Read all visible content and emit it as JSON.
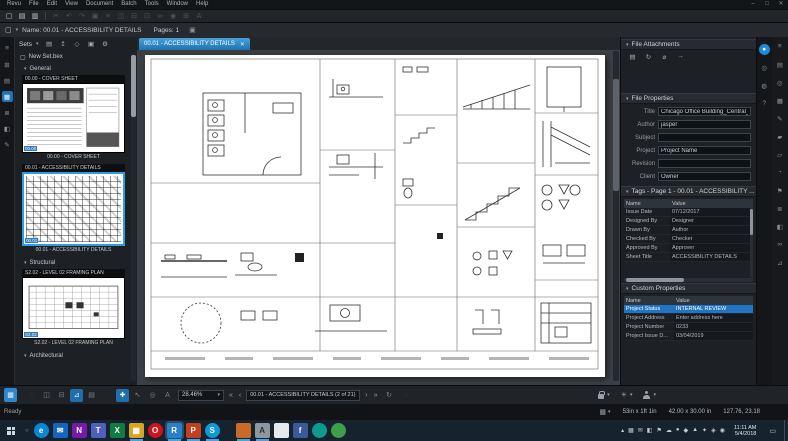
{
  "app": {
    "menus": [
      "Revu",
      "File",
      "Edit",
      "View",
      "Document",
      "Batch",
      "Tools",
      "Window",
      "Help"
    ],
    "window_controls": [
      {
        "name": "minimize-button",
        "glyph": "–"
      },
      {
        "name": "maximize-button",
        "glyph": "□"
      },
      {
        "name": "close-button",
        "glyph": "✕"
      }
    ]
  },
  "toolbar": {
    "icons": [
      {
        "name": "new-document-icon",
        "glyph": "▢"
      },
      {
        "name": "open-file-icon",
        "glyph": "▤"
      },
      {
        "name": "save-file-icon",
        "glyph": "▥"
      },
      {
        "name": "toolbar-separator",
        "glyph": "",
        "cls": "sep"
      },
      {
        "name": "cut-icon",
        "glyph": "✂",
        "cls": "dim"
      },
      {
        "name": "undo-icon",
        "glyph": "↶",
        "cls": "dim"
      },
      {
        "name": "redo-icon",
        "glyph": "↷",
        "cls": "dim"
      },
      {
        "name": "paste-icon",
        "glyph": "▣",
        "cls": "dim"
      },
      {
        "name": "flatten-icon",
        "glyph": "≡",
        "cls": "dim"
      },
      {
        "name": "compare-icon",
        "glyph": "◫",
        "cls": "dim"
      },
      {
        "name": "overlay-icon",
        "glyph": "⊟",
        "cls": "dim"
      },
      {
        "name": "snapshot-icon",
        "glyph": "⊡",
        "cls": "dim"
      },
      {
        "name": "link-icon",
        "glyph": "∞",
        "cls": "dim"
      },
      {
        "name": "stamp-icon",
        "glyph": "◉",
        "cls": "dim"
      },
      {
        "name": "form-icon",
        "glyph": "⊞",
        "cls": "dim"
      },
      {
        "name": "ocr-icon",
        "glyph": "A",
        "cls": "dim"
      }
    ]
  },
  "infobar": {
    "doc_icon": "▢",
    "caret": "▾",
    "name_label": "Name: 00.01 - ACCESSIBILITY DETAILS",
    "pages_label": "Pages: 1",
    "copy_icon": "▣"
  },
  "left_rail": {
    "icons": [
      {
        "name": "file-access-panel-icon",
        "glyph": "≡"
      },
      {
        "name": "thumbnails-panel-icon",
        "glyph": "⊞"
      },
      {
        "name": "bookmarks-panel-icon",
        "glyph": "▤"
      },
      {
        "name": "sets-panel-icon",
        "glyph": "▦",
        "cls": "active"
      },
      {
        "name": "layers-panel-icon",
        "glyph": "≣"
      },
      {
        "name": "spaces-panel-icon",
        "glyph": "◧"
      },
      {
        "name": "signatures-panel-icon",
        "glyph": "✎"
      }
    ]
  },
  "sidebar": {
    "sets_label": "Sets",
    "sets_caret": "▾",
    "tools": [
      {
        "name": "open-set-icon",
        "glyph": "▤"
      },
      {
        "name": "add-to-set-icon",
        "glyph": "↥"
      },
      {
        "name": "tag-set-icon",
        "glyph": "◇"
      },
      {
        "name": "lock-set-icon",
        "glyph": "▣"
      },
      {
        "name": "set-settings-icon",
        "glyph": "⚙"
      }
    ],
    "new_set_icon": "▢",
    "new_set_label": "New Set.bex",
    "sections": [
      {
        "caret": "▾",
        "label": "General"
      },
      {
        "caret": "▾",
        "label": "Structural"
      },
      {
        "caret": "▾",
        "label": "Architectural"
      }
    ],
    "items": [
      {
        "title": "00.00 - COVER SHEET",
        "caption": "00.00 - COVER SHEET",
        "chip": "00.00"
      },
      {
        "title": "00.01 - ACCESSIBILITY DETAILS",
        "caption": "00.01 - ACCESSIBILITY DETAILS",
        "chip": "00.01"
      },
      {
        "title": "S2.02 - LEVEL 02 FRAMING PLAN",
        "caption": "S2.02 - LEVEL 02 FRAMING PLAN",
        "chip": "S2.02"
      }
    ]
  },
  "document": {
    "tab_label": "00.01 - ACCESSIBILITY DETAILS",
    "tab_close": "✕"
  },
  "right_panel": {
    "attachments": {
      "caret": "▾",
      "label": "File Attachments",
      "icons": [
        {
          "name": "attachment-folder-icon",
          "glyph": "▤"
        },
        {
          "name": "attachment-refresh-icon",
          "glyph": "↻"
        },
        {
          "name": "paperclip-icon",
          "glyph": "⌀"
        },
        {
          "name": "attachment-open-icon",
          "glyph": "→"
        }
      ]
    },
    "properties": {
      "caret": "▾",
      "label": "File Properties",
      "fields": [
        {
          "label": "Title",
          "value": "Chicago Office Building_Central_par"
        },
        {
          "label": "Author",
          "value": "jasper"
        },
        {
          "label": "Subject",
          "value": ""
        },
        {
          "label": "Project",
          "value": "Project Name"
        },
        {
          "label": "Revision",
          "value": ""
        },
        {
          "label": "Client",
          "value": "Owner"
        }
      ]
    },
    "tags": {
      "caret": "▾",
      "label": "Tags - Page 1 - 00.01 - ACCESSIBILITY ...",
      "col_name": "Name",
      "col_value": "Value",
      "rows": [
        [
          "Issue Date",
          "07/12/2017"
        ],
        [
          "Designed By",
          "Designer"
        ],
        [
          "Drawn By",
          "Author"
        ],
        [
          "Checked By",
          "Checker"
        ],
        [
          "Approved By",
          "Approver"
        ],
        [
          "Sheet Title",
          "ACCESSIBILITY DETAILS"
        ]
      ]
    },
    "custom": {
      "caret": "▾",
      "label": "Custom Properties",
      "col_name": "Name",
      "col_value": "Value",
      "rows": [
        [
          "Project Status",
          "INTERNAL REVIEW"
        ],
        [
          "Project Address",
          "Enter address here"
        ],
        [
          "Project Number",
          "0233"
        ],
        [
          "Project Issue D...",
          "03/04/2019"
        ]
      ]
    }
  },
  "right_rail": {
    "inner": [
      {
        "name": "studio-panel-icon",
        "glyph": "●",
        "cls": "active"
      },
      {
        "name": "search-panel-icon",
        "glyph": "◎"
      },
      {
        "name": "comments-panel-icon",
        "glyph": "◍"
      },
      {
        "name": "help-panel-icon",
        "glyph": "?"
      }
    ],
    "outer": [
      {
        "name": "properties-panel-icon",
        "glyph": "≡"
      },
      {
        "name": "markup-list-icon",
        "glyph": "▤"
      },
      {
        "name": "search-icon",
        "glyph": "◎"
      },
      {
        "name": "tool-chest-icon",
        "glyph": "▦"
      },
      {
        "name": "pen-tool-icon",
        "glyph": "✎"
      },
      {
        "name": "highlight-tool-icon",
        "glyph": "▰"
      },
      {
        "name": "eraser-tool-icon",
        "glyph": "▱"
      },
      {
        "name": "recents-panel-icon",
        "glyph": "◔"
      },
      {
        "name": "flag-panel-icon",
        "glyph": "⚑"
      },
      {
        "name": "list-panel-icon",
        "glyph": "≣"
      },
      {
        "name": "image-panel-icon",
        "glyph": "◧"
      },
      {
        "name": "hyperlink-panel-icon",
        "glyph": "∞"
      },
      {
        "name": "measure-panel-icon",
        "glyph": "⊿"
      }
    ]
  },
  "navbar": {
    "panel_toggle_glyph": "▦",
    "mode_icons": [
      {
        "name": "presentation-mode-icon",
        "glyph": "◌",
        "cls": "dim"
      },
      {
        "name": "split-vertical-icon",
        "glyph": "◫"
      },
      {
        "name": "split-horizontal-icon",
        "glyph": "⊟"
      },
      {
        "name": "measure-tool-icon",
        "glyph": "⊿",
        "cls": "on"
      },
      {
        "name": "sketch-tool-icon",
        "glyph": "▤"
      }
    ],
    "tool_icons": [
      {
        "name": "pan-tool-icon",
        "glyph": "✚",
        "cls": "on"
      },
      {
        "name": "select-tool-icon",
        "glyph": "↖"
      },
      {
        "name": "zoom-tool-icon",
        "glyph": "◎"
      },
      {
        "name": "select-text-icon",
        "glyph": "A"
      }
    ],
    "zoom_value": "28.46%",
    "zoom_caret": "▾",
    "nav_first": "«",
    "nav_prev": "‹",
    "page_selector": "00.01 - ACCESSIBILITY DETAILS (2 of 21)",
    "nav_next": "›",
    "nav_last": "»",
    "sync_glyph": "↻",
    "extra_glyph": "◌",
    "lock_caret": "▾",
    "brightness_glyph": "☀",
    "brightness_caret": "▾",
    "profile_caret": "▾"
  },
  "statusbar": {
    "ready": "Ready",
    "panel_icon": "▦",
    "panel_caret": "▾",
    "measurement": "53in x 1ft 1in",
    "page_size": "42.00 x 30.00 in",
    "cursor_position": "127.76, 23.18"
  },
  "taskbar": {
    "search_glyph": "○",
    "apps": [
      {
        "name": "edge-app-icon",
        "glyph": "e",
        "bg": "#0b86d4",
        "cls": "circle"
      },
      {
        "name": "mail-app-icon",
        "glyph": "✉",
        "bg": "#1565c0"
      },
      {
        "name": "onenote-app-icon",
        "glyph": "N",
        "bg": "#7719aa"
      },
      {
        "name": "teams-app-icon",
        "glyph": "T",
        "bg": "#4e5fbf"
      },
      {
        "name": "excel-app-icon",
        "glyph": "X",
        "bg": "#107c41"
      },
      {
        "name": "explorer-app-icon",
        "glyph": "▦",
        "bg": "#d9a521",
        "cls": "active"
      },
      {
        "name": "opera-app-icon",
        "glyph": "O",
        "bg": "#d1111b",
        "cls": "circle"
      },
      {
        "name": "revu-app-icon",
        "glyph": "R",
        "bg": "#2a7fc9",
        "cls": "active focused"
      },
      {
        "name": "powerpoint-app-icon",
        "glyph": "P",
        "bg": "#c2401d",
        "cls": "active"
      },
      {
        "name": "skype-app-icon",
        "glyph": "S",
        "bg": "#0d9ad6",
        "cls": "circle active"
      }
    ],
    "apps2": [
      {
        "name": "open-window-icon",
        "glyph": "",
        "bg": "#c96a26",
        "cls": "active"
      },
      {
        "name": "open-window-icon",
        "glyph": "A",
        "bg": "#8e979e",
        "cls": "active"
      },
      {
        "name": "open-window-icon",
        "glyph": "",
        "bg": "#e7eaec"
      },
      {
        "name": "open-window-icon",
        "glyph": "f",
        "bg": "#3b5998"
      },
      {
        "name": "open-window-icon",
        "glyph": "",
        "bg": "#0e9b8f",
        "cls": "circle"
      },
      {
        "name": "open-window-icon",
        "glyph": "",
        "bg": "#3f9e49",
        "cls": "circle"
      }
    ],
    "tray_expand_glyph": "▴",
    "tray": [
      {
        "name": "tray-icon",
        "glyph": "▦"
      },
      {
        "name": "tray-icon",
        "glyph": "✉"
      },
      {
        "name": "tray-icon",
        "glyph": "◧"
      },
      {
        "name": "tray-icon",
        "glyph": "⚑"
      },
      {
        "name": "tray-icon",
        "glyph": "☁"
      },
      {
        "name": "tray-icon",
        "glyph": "●"
      },
      {
        "name": "tray-icon",
        "glyph": "◆"
      },
      {
        "name": "tray-icon",
        "glyph": "▲"
      },
      {
        "name": "tray-icon",
        "glyph": "✦"
      },
      {
        "name": "tray-icon",
        "glyph": "◈"
      },
      {
        "name": "tray-icon",
        "glyph": "◉"
      }
    ],
    "clock": {
      "time": "11:11 AM",
      "date": "5/4/2018"
    },
    "notification_glyph": "▭"
  }
}
